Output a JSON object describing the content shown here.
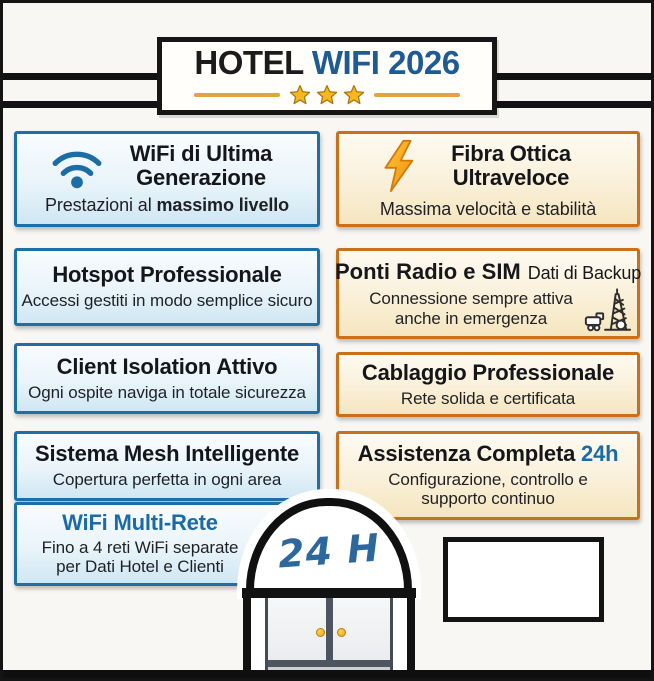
{
  "header": {
    "title_hotel": "HOTEL",
    "title_wifi": "WIFI 2026",
    "star_count": 3
  },
  "cards": {
    "wifi_generation": {
      "title": "WiFi di Ultima Generazione",
      "subtitle_prefix": "Prestazioni al ",
      "subtitle_bold": "massimo livello",
      "icon": "wifi-icon"
    },
    "fibra": {
      "title": "Fibra Ottica Ultraveloce",
      "subtitle": "Massima velocità e stabilità",
      "icon": "lightning-icon"
    },
    "hotspot": {
      "title": "Hotspot Professionale",
      "subtitle": "Accessi gestiti in modo semplice sicuro"
    },
    "ponti_radio": {
      "title_bold": "Ponti Radio e SIM",
      "title_suffix": "Dati di Backup",
      "subtitle": "Connessione sempre attiva anche in emergenza",
      "icon": "radio-tower-icon"
    },
    "client_isolation": {
      "title": "Client Isolation Attivo",
      "subtitle": "Ogni ospite naviga in totale sicurezza"
    },
    "cablaggio": {
      "title": "Cablaggio Professionale",
      "subtitle": "Rete solida e certificata"
    },
    "mesh": {
      "title": "Sistema Mesh Intelligente",
      "subtitle": "Copertura perfetta in ogni area"
    },
    "assistenza": {
      "title_prefix": "Assistenza Completa ",
      "title_highlight": "24h",
      "subtitle": "Configurazione, controllo e supporto continuo"
    },
    "multi_rete": {
      "title": "WiFi Multi-Rete",
      "subtitle": "Fino a 4 reti WiFi separate per Dati Hotel e Clienti"
    }
  },
  "door": {
    "label": "24 H"
  },
  "colors": {
    "blue_accent": "#1d6fa5",
    "orange_accent": "#c8711c",
    "title_blue": "#1e5b93",
    "gold": "#e2a43c",
    "highlight_blue": "#1c6ba6"
  }
}
